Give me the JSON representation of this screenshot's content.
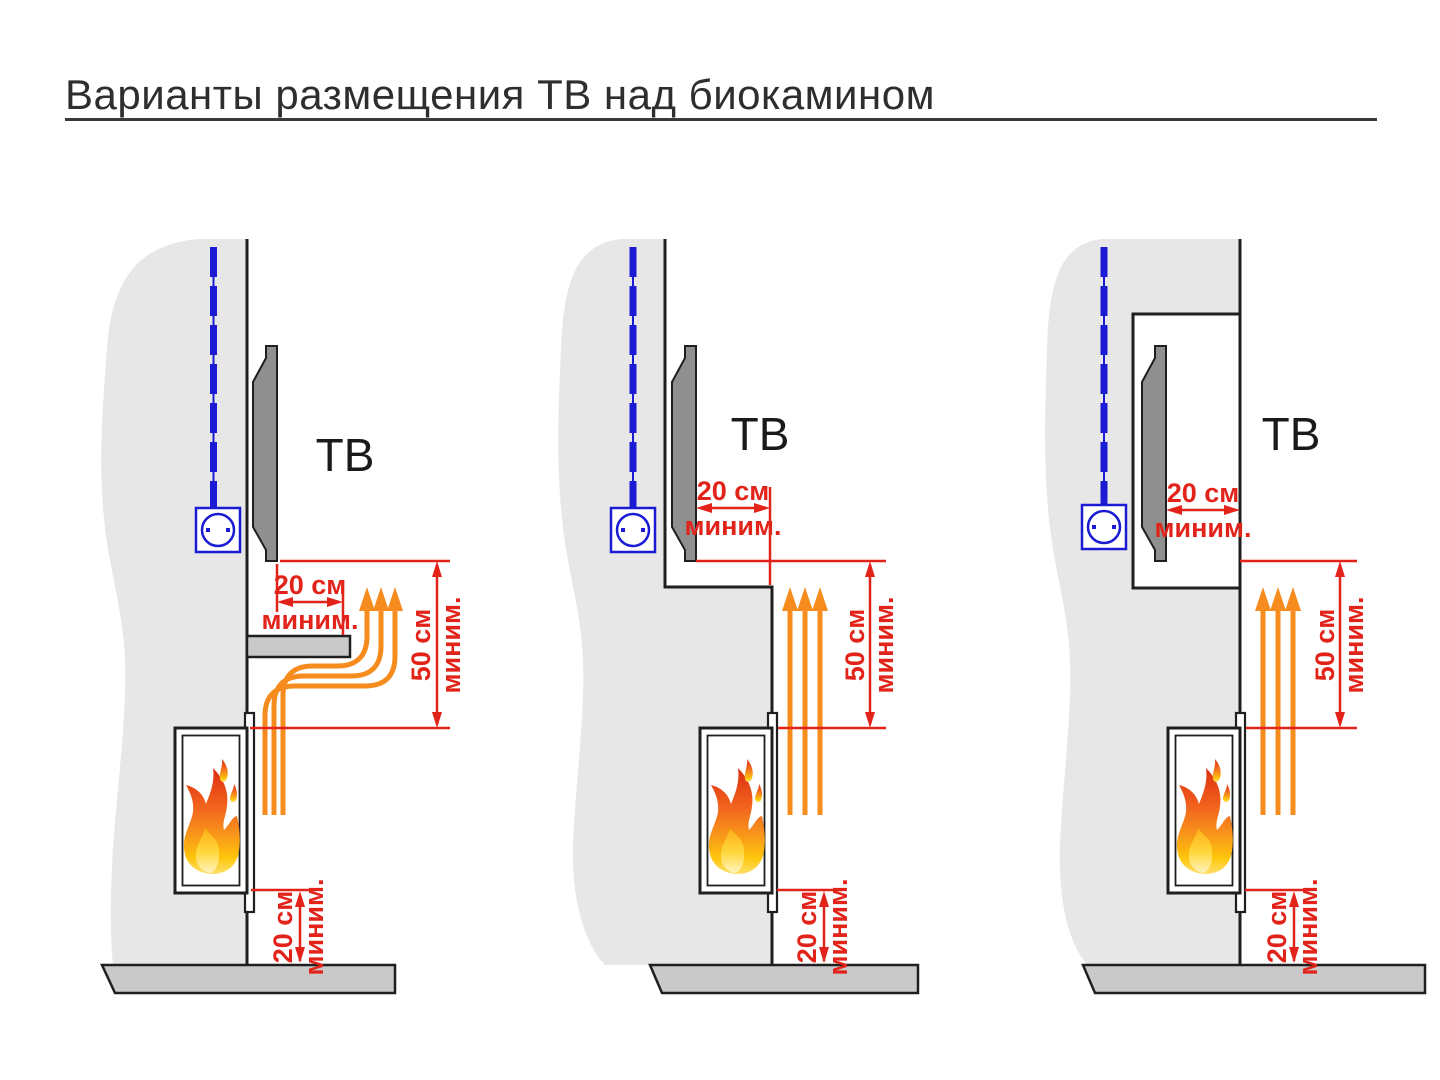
{
  "title": "Варианты размещения ТВ над биокамином",
  "colors": {
    "dimension_red": "#e2231a",
    "airflow_orange": "#f68b1e",
    "cable_blue": "#1b1bd4",
    "wall_gray": "#e7e7e7",
    "floor_gray": "#c9c9c9",
    "tv_gray": "#8f8f8f",
    "outline_black": "#1f1f1f"
  },
  "diagrams": [
    {
      "id": "variant-1",
      "tv_label": "ТВ",
      "shelf_gap": {
        "value": "20 см",
        "qualifier": "миним."
      },
      "vertical_clearance": {
        "value": "50 см",
        "qualifier": "миним."
      },
      "floor_clearance": {
        "value": "20 см",
        "qualifier": "миним."
      }
    },
    {
      "id": "variant-2",
      "tv_label": "ТВ",
      "recess_depth": {
        "value": "20 см",
        "qualifier": "миним."
      },
      "vertical_clearance": {
        "value": "50 см",
        "qualifier": "миним."
      },
      "floor_clearance": {
        "value": "20 см",
        "qualifier": "миним."
      }
    },
    {
      "id": "variant-3",
      "tv_label": "ТВ",
      "niche_depth": {
        "value": "20 см",
        "qualifier": "миним."
      },
      "vertical_clearance": {
        "value": "50 см",
        "qualifier": "миним."
      },
      "floor_clearance": {
        "value": "20 см",
        "qualifier": "миним."
      }
    }
  ]
}
